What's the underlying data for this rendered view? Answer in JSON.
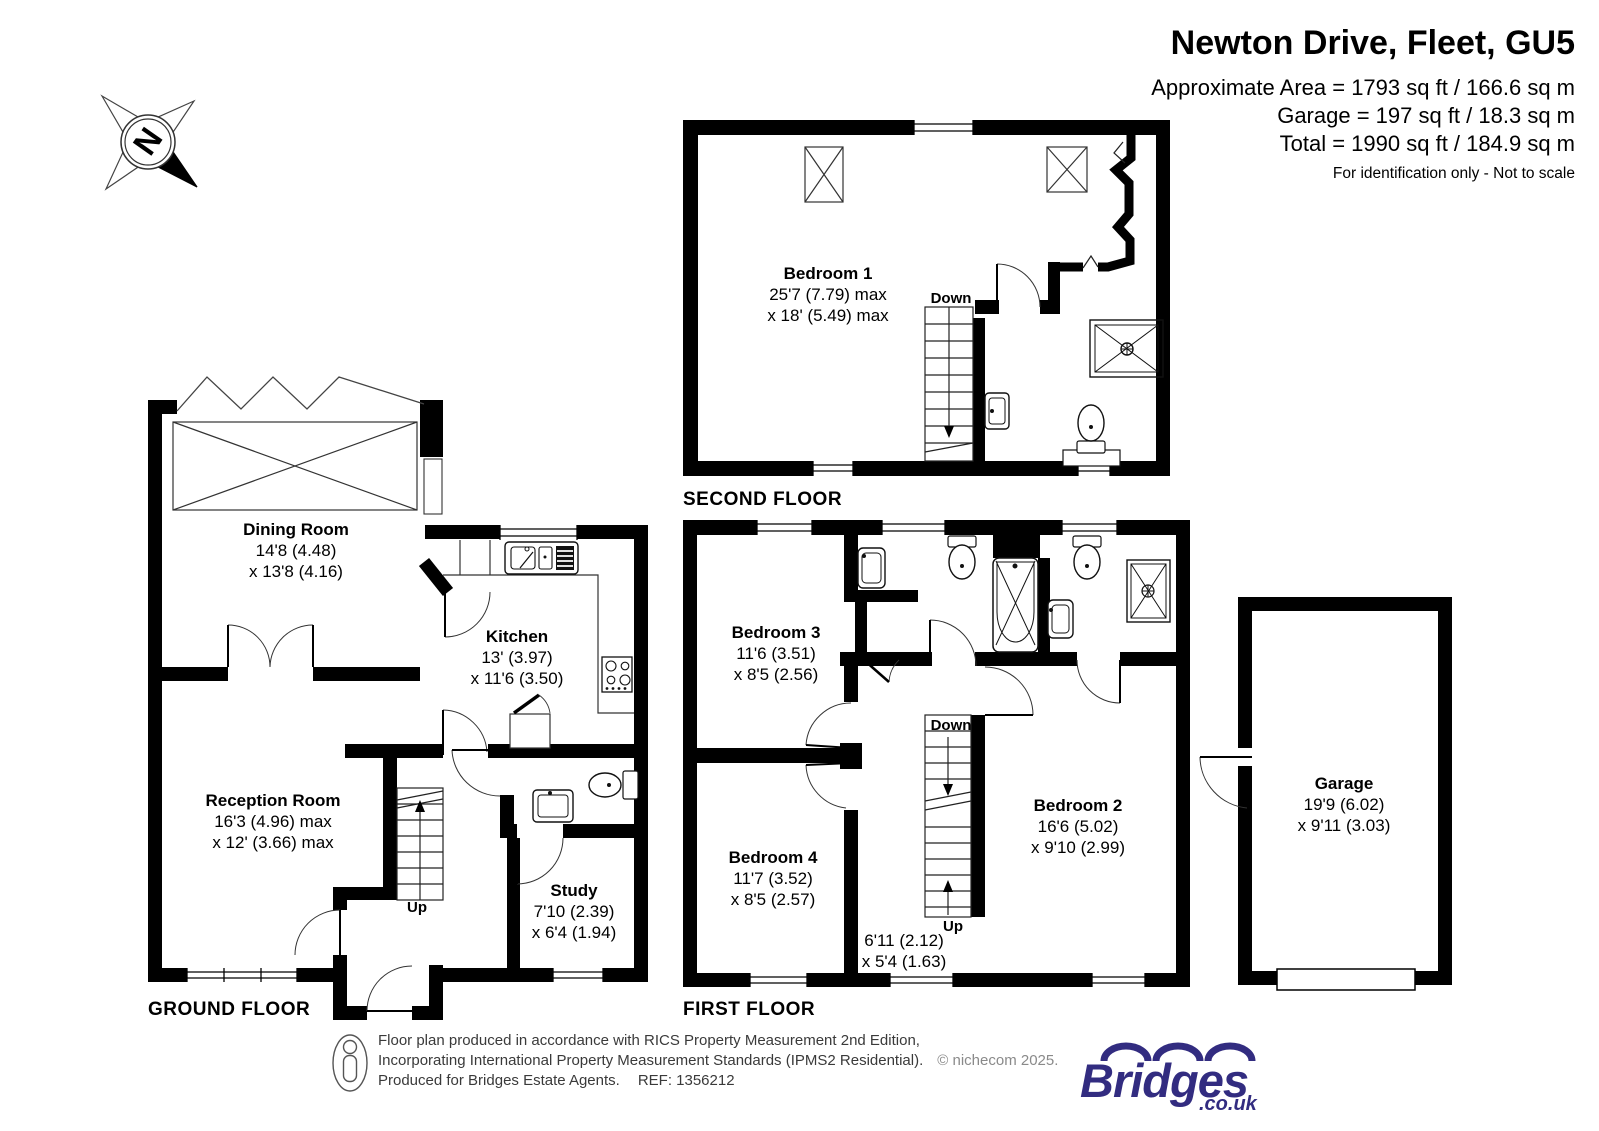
{
  "header": {
    "title": "Newton Drive, Fleet, GU5",
    "area_line1": "Approximate Area = 1793 sq ft / 166.6 sq m",
    "area_line2": "Garage = 197 sq ft / 18.3 sq m",
    "area_line3": "Total = 1990 sq ft / 184.9 sq m",
    "disclaimer": "For identification only - Not to scale"
  },
  "compass": {
    "north": "N"
  },
  "floors": {
    "second": {
      "label": "SECOND FLOOR",
      "stairs_down": "Down"
    },
    "first": {
      "label": "FIRST FLOOR",
      "stairs_down": "Down",
      "stairs_up": "Up"
    },
    "ground": {
      "label": "GROUND FLOOR",
      "stairs_up": "Up"
    }
  },
  "rooms": {
    "bedroom1": {
      "name": "Bedroom 1",
      "dim1": "25'7 (7.79) max",
      "dim2": "x 18' (5.49) max"
    },
    "bedroom2": {
      "name": "Bedroom 2",
      "dim1": "16'6 (5.02)",
      "dim2": "x 9'10 (2.99)"
    },
    "bedroom3": {
      "name": "Bedroom 3",
      "dim1": "11'6 (3.51)",
      "dim2": "x 8'5 (2.56)"
    },
    "bedroom4": {
      "name": "Bedroom 4",
      "dim1": "11'7 (3.52)",
      "dim2": "x 8'5 (2.57)"
    },
    "landing": {
      "dim1": "6'11 (2.12)",
      "dim2": "x 5'4 (1.63)"
    },
    "dining": {
      "name": "Dining Room",
      "dim1": "14'8 (4.48)",
      "dim2": "x 13'8 (4.16)"
    },
    "kitchen": {
      "name": "Kitchen",
      "dim1": "13' (3.97)",
      "dim2": "x 11'6 (3.50)"
    },
    "reception": {
      "name": "Reception Room",
      "dim1": "16'3 (4.96) max",
      "dim2": "x 12' (3.66) max"
    },
    "study": {
      "name": "Study",
      "dim1": "7'10 (2.39)",
      "dim2": "x 6'4 (1.94)"
    },
    "garage": {
      "name": "Garage",
      "dim1": "19'9 (6.02)",
      "dim2": "x 9'11 (3.03)"
    }
  },
  "footer": {
    "line1": "Floor plan produced in accordance with RICS Property Measurement 2nd Edition,",
    "line2": "Incorporating International Property Measurement Standards (IPMS2 Residential).",
    "copyright": "© nichecom 2025.",
    "line3": "Produced for Bridges Estate Agents.",
    "ref": "REF: 1356212",
    "logo_text": "Bridges",
    "logo_suffix": ".co.uk"
  },
  "colors": {
    "wall": "#000000",
    "logo": "#322c80"
  }
}
